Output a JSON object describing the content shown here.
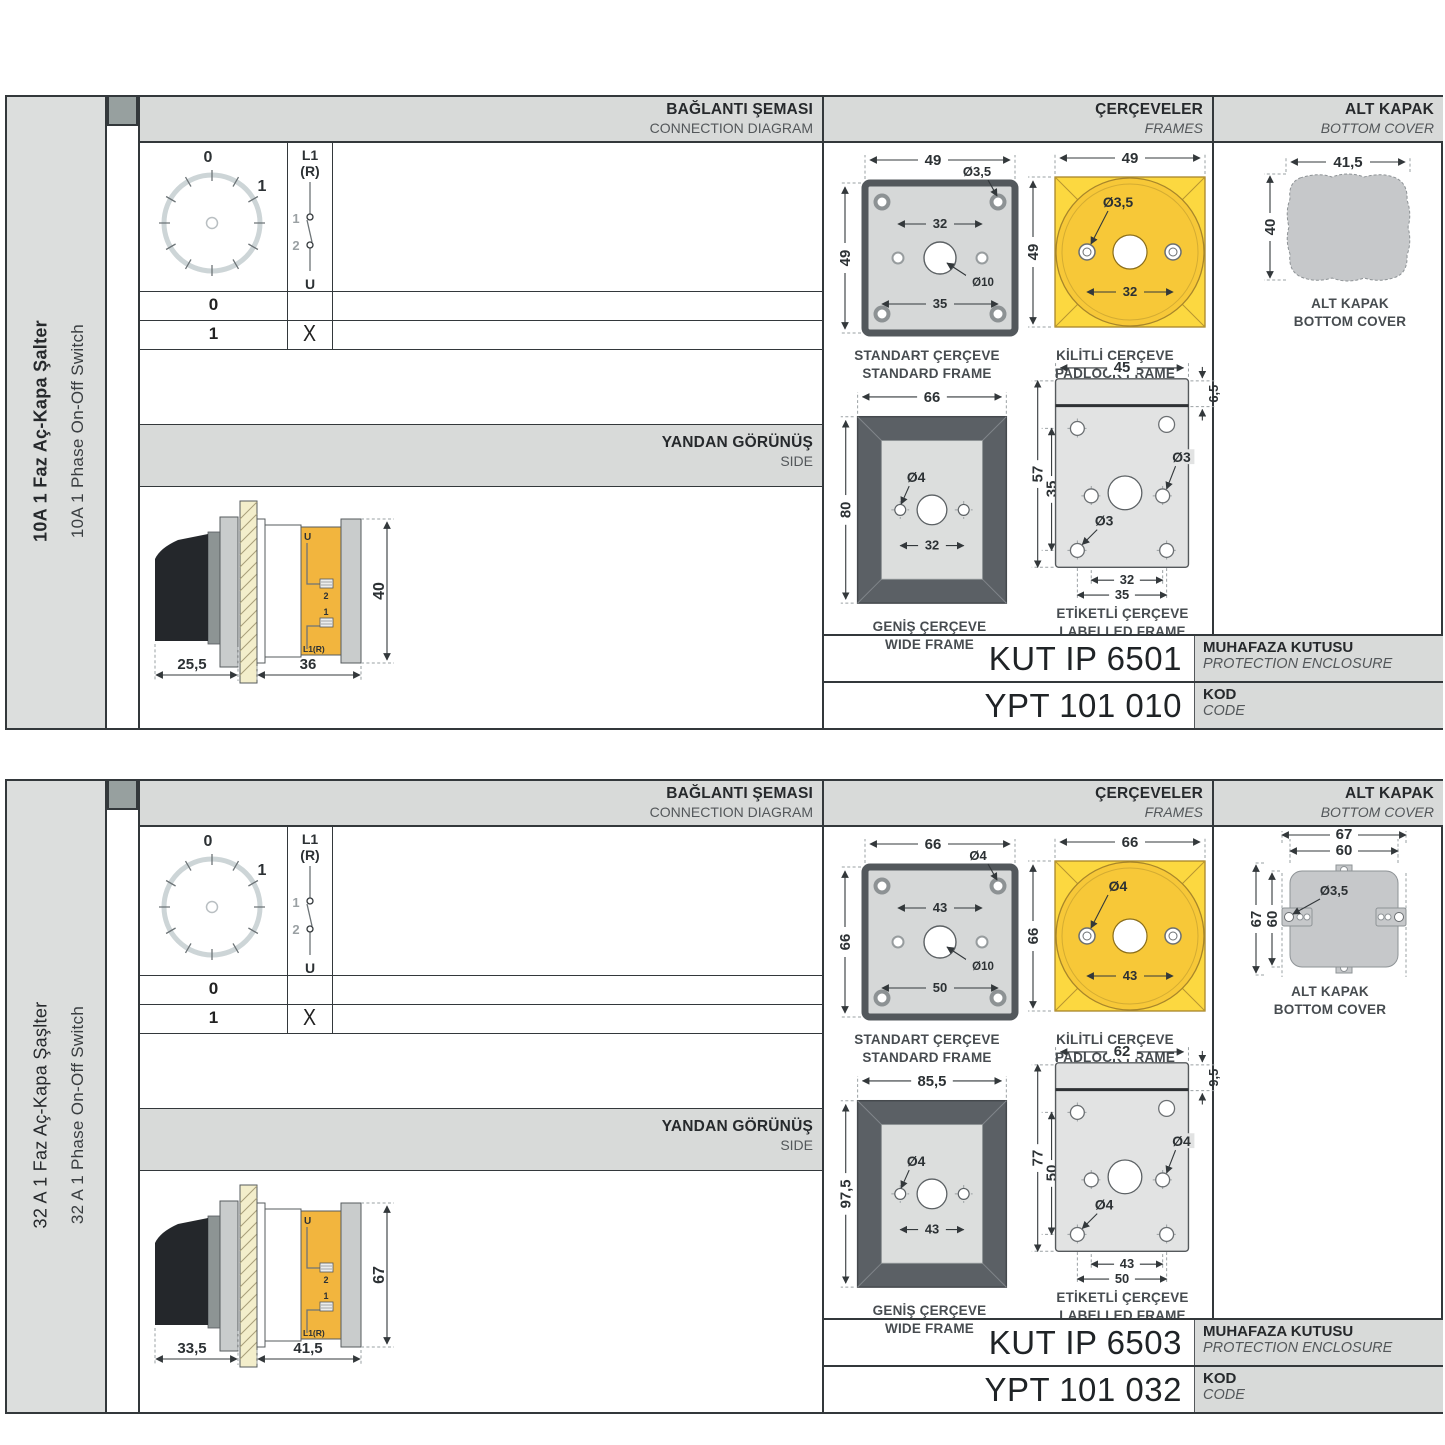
{
  "colors": {
    "panel_gray": "#dcdedd",
    "header_gray": "#d8dad9",
    "border_dark": "#33383b",
    "frame_yellow": "#fcd840",
    "frame_yellow_deep": "#f7c838",
    "terminal_amber": "#f2b53e",
    "frame_gray_fill": "#d6d8d8",
    "wide_frame_dark": "#5b6065",
    "cover_gray": "#c6c8ca",
    "hatch_cream": "#f3eecb",
    "handle_black": "#24272b"
  },
  "sections": [
    {
      "product_tr": "10A 1 Faz Aç-Kapa Şalter",
      "product_en": "10A 1 Phase On-Off Switch",
      "headers": {
        "connection_tr": "BAĞLANTI ŞEMASI",
        "connection_en": "CONNECTION DIAGRAM",
        "frames_tr": "ÇERÇEVELER",
        "frames_en": "FRAMES",
        "cover_tr": "ALT KAPAK",
        "cover_en": "BOTTOM COVER",
        "side_tr": "YANDAN GÖRÜNÜŞ",
        "side_en": "SIDE"
      },
      "dial": {
        "pos0": "0",
        "pos1": "1"
      },
      "switch": {
        "line": "L1",
        "line2": "(R)",
        "c1": "1",
        "c2": "2",
        "out": "U"
      },
      "table": {
        "row0": {
          "pos": "0",
          "mark": ""
        },
        "row1": {
          "pos": "1",
          "mark": "X"
        }
      },
      "side_view": {
        "dim_front": "25,5",
        "dim_body": "36",
        "dim_height": "40",
        "term_u": "U",
        "term_2": "2",
        "term_1": "1",
        "term_l1r": "L1(R)"
      },
      "standard_frame": {
        "title_tr": "STANDART ÇERÇEVE",
        "title_en": "STANDARD FRAME",
        "dim_w": "49",
        "dim_h": "49",
        "dim_hole": "Ø3,5",
        "dim_span": "32",
        "dim_center": "Ø10",
        "dim_outer": "35"
      },
      "padlock_frame": {
        "title_tr": "KİLİTLİ ÇERÇEVE",
        "title_en": "PADLOCK FRAME",
        "dim_w": "49",
        "dim_h": "49",
        "dim_hole": "Ø3,5",
        "dim_span": "32"
      },
      "wide_frame": {
        "title_tr": "GENİŞ ÇERÇEVE",
        "title_en": "WIDE FRAME",
        "dim_w": "66",
        "dim_h": "80",
        "dim_hole": "Ø4",
        "dim_span": "32"
      },
      "labelled_frame": {
        "title_tr": "ETİKETLİ ÇERÇEVE",
        "title_en": "LABELLED FRAME",
        "dim_w": "45",
        "dim_label": "6,5",
        "dim_h": "57",
        "dim_inner": "35",
        "dim_hole_right": "Ø3",
        "dim_hole_left": "Ø3",
        "dim_span": "32",
        "dim_outer": "35"
      },
      "bottom_cover": {
        "title_tr": "ALT KAPAK",
        "title_en": "BOTTOM COVER",
        "dim_w": "41,5",
        "dim_h": "40"
      },
      "enclosure": {
        "code": "KUT IP 6501",
        "label_tr": "MUHAFAZA KUTUSU",
        "label_en": "PROTECTION ENCLOSURE"
      },
      "product_code": {
        "code": "YPT 101 010",
        "label_tr": "KOD",
        "label_en": "CODE"
      }
    },
    {
      "product_tr": "32 A 1 Faz Aç-Kapa Şaşlter",
      "product_en": "32 A 1 Phase On-Off Switch",
      "headers": {
        "connection_tr": "BAĞLANTI ŞEMASI",
        "connection_en": "CONNECTION DIAGRAM",
        "frames_tr": "ÇERÇEVELER",
        "frames_en": "FRAMES",
        "cover_tr": "ALT KAPAK",
        "cover_en": "BOTTOM COVER",
        "side_tr": "YANDAN GÖRÜNÜŞ",
        "side_en": "SIDE"
      },
      "dial": {
        "pos0": "0",
        "pos1": "1"
      },
      "switch": {
        "line": "L1",
        "line2": "(R)",
        "c1": "1",
        "c2": "2",
        "out": "U"
      },
      "table": {
        "row0": {
          "pos": "0",
          "mark": ""
        },
        "row1": {
          "pos": "1",
          "mark": "X"
        }
      },
      "side_view": {
        "dim_front": "33,5",
        "dim_body": "41,5",
        "dim_height": "67",
        "term_u": "U",
        "term_2": "2",
        "term_1": "1",
        "term_l1r": "L1(R)"
      },
      "standard_frame": {
        "title_tr": "STANDART ÇERÇEVE",
        "title_en": "STANDARD FRAME",
        "dim_w": "66",
        "dim_h": "66",
        "dim_hole": "Ø4",
        "dim_span": "43",
        "dim_center": "Ø10",
        "dim_outer": "50"
      },
      "padlock_frame": {
        "title_tr": "KİLİTLİ ÇERÇEVE",
        "title_en": "PADLOCK FRAME",
        "dim_w": "66",
        "dim_h": "66",
        "dim_hole": "Ø4",
        "dim_span": "43"
      },
      "wide_frame": {
        "title_tr": "GENİŞ ÇERÇEVE",
        "title_en": "WIDE FRAME",
        "dim_w": "85,5",
        "dim_h": "97,5",
        "dim_hole": "Ø4",
        "dim_span": "43"
      },
      "labelled_frame": {
        "title_tr": "ETİKETLİ ÇERÇEVE",
        "title_en": "LABELLED FRAME",
        "dim_w": "62",
        "dim_label": "9,5",
        "dim_h": "77",
        "dim_inner": "50",
        "dim_hole_right": "Ø4",
        "dim_hole_left": "Ø4",
        "dim_span": "43",
        "dim_outer": "50"
      },
      "bottom_cover": {
        "title_tr": "ALT KAPAK",
        "title_en": "BOTTOM COVER",
        "dim_w_outer": "67",
        "dim_w_inner": "60",
        "dim_h_outer": "67",
        "dim_h_inner": "60",
        "dim_hole": "Ø3,5"
      },
      "enclosure": {
        "code": "KUT IP 6503",
        "label_tr": "MUHAFAZA KUTUSU",
        "label_en": "PROTECTION ENCLOSURE"
      },
      "product_code": {
        "code": "YPT 101 032",
        "label_tr": "KOD",
        "label_en": "CODE"
      }
    }
  ]
}
